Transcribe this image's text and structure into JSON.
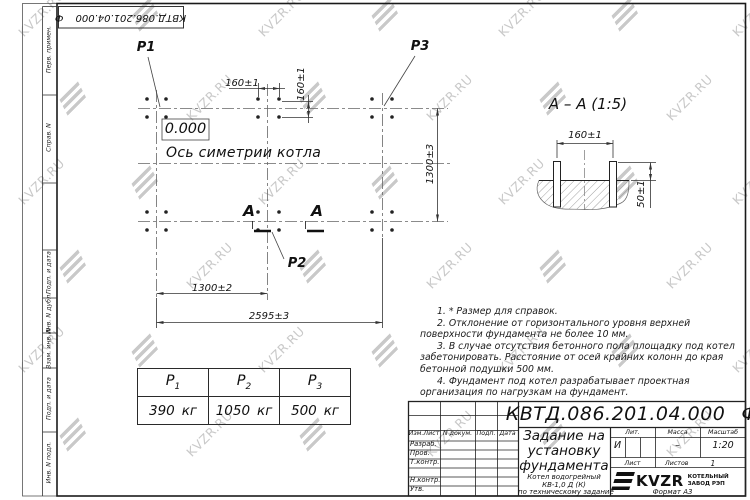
{
  "watermark": {
    "text": "KVZR.RU"
  },
  "doc_code": {
    "code": "КВТД.086.201.04.000",
    "suffix": "Ф"
  },
  "side_strip": {
    "labels": [
      "Перв. примен.",
      "Справ. N",
      "Подп. и дата",
      "Инв. N дубл.",
      "Взам. инв. N",
      "Подп. и дата",
      "Инв. N подл."
    ]
  },
  "plan": {
    "load_labels": {
      "p1": "Р1",
      "p2": "Р2",
      "p3": "Р3"
    },
    "elevation": "0.000",
    "axis_label": "Ось симетрии котла",
    "section_letter": "А",
    "dims": {
      "bolt_spacing_h": "160±1",
      "bolt_spacing_v": "160±1",
      "width": "1300±3",
      "half_length": "1300±2",
      "full_length": "2595±3"
    }
  },
  "section_view": {
    "title": "А – А (1:5)",
    "dims": {
      "bolt_spacing": "160±1",
      "bolt_height": "50±1"
    }
  },
  "notes": [
    "1. * Размер для справок.",
    "2. Отклонение от горизонтального уровня верхней поверхности фундамента не более 10 мм.",
    "3. В случае отсутствия бетонного пола площадку под котел забетонировать. Расстояние от осей крайних колонн до края бетонной подушки 500 мм.",
    "4. Фундамент под котел разрабатывает проектная организация по нагрузкам на фундамент."
  ],
  "loads_table": {
    "columns": [
      {
        "base": "Р",
        "sub": "1",
        "value": "390",
        "unit": "кг"
      },
      {
        "base": "Р",
        "sub": "2",
        "value": "1050",
        "unit": "кг"
      },
      {
        "base": "Р",
        "sub": "3",
        "value": "500",
        "unit": "кг"
      }
    ]
  },
  "title_block": {
    "revision_cols": [
      "Изм.Лист",
      "N докум.",
      "Подп.",
      "Дата"
    ],
    "roles": [
      "Разраб.",
      "Пров.",
      "Т.контр.",
      "",
      "Н.контр.",
      "Утв."
    ],
    "title_lines": [
      "Задание на",
      "установку",
      "фундамента"
    ],
    "subtitle_lines": [
      "Котел водогрейный",
      "КВ-1,0 Д (К)",
      "по техническому задание"
    ],
    "lit_label": "Лит.",
    "mass_label": "Масса",
    "scale_label": "Масштаб",
    "lit_value": "И",
    "mass_value": "–",
    "scale_value": "1:20",
    "sheet_label": "Лист",
    "sheets_label": "Листов",
    "sheets_value": "1",
    "logo_text": "KVZR",
    "logo_org_line1": "КОТЕЛЬНЫЙ",
    "logo_org_line2": "ЗАВОД РЭП"
  },
  "format_label": "Формат А3"
}
